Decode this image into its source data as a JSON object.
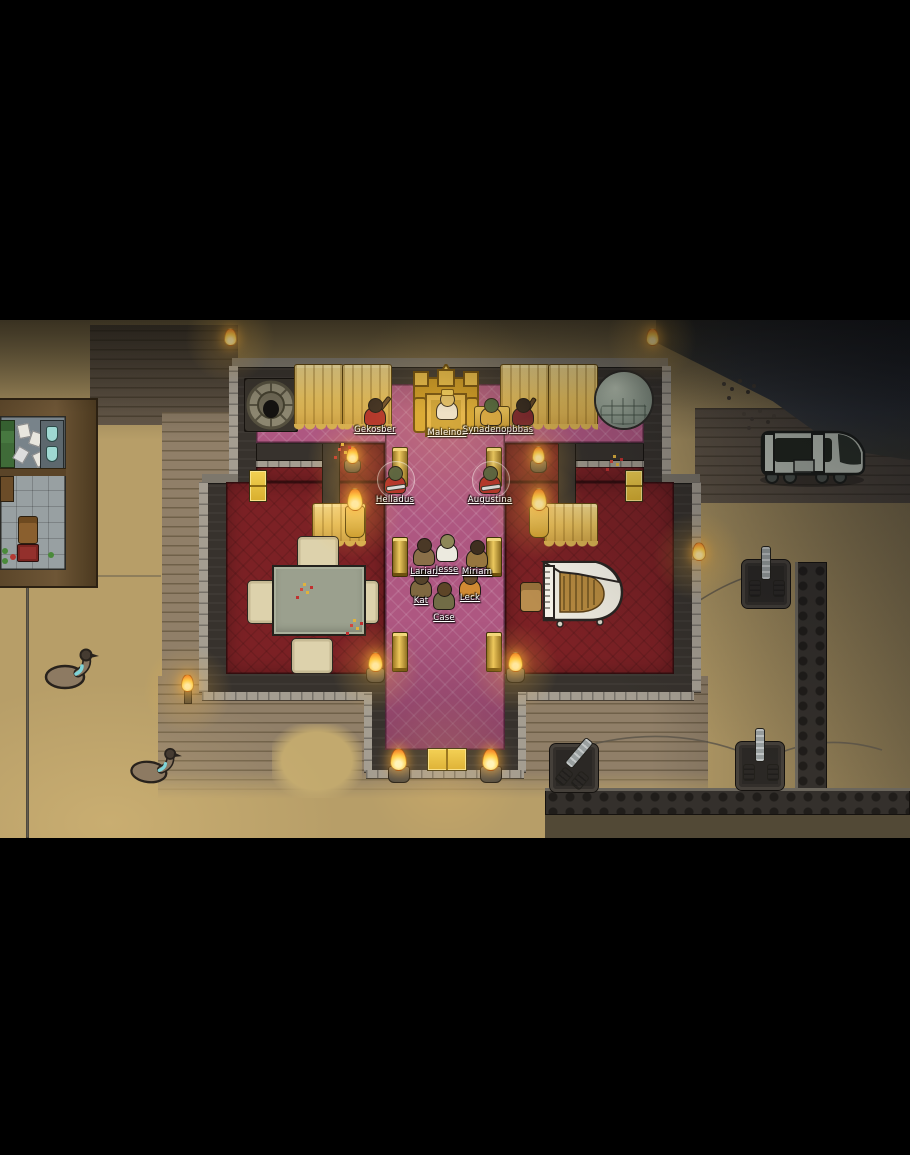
{
  "pawns": [
    {
      "name": "Gekosber",
      "outfit_color": "#b03028"
    },
    {
      "name": "Maleinos",
      "outfit_color": "#ece7db"
    },
    {
      "name": "Synadenopbbas",
      "outfit_color": "#d9a93f"
    },
    {
      "name": "Helladus",
      "outfit_color": "#b23028"
    },
    {
      "name": "Augustina",
      "outfit_color": "#b23028"
    },
    {
      "name": "Larian",
      "outfit_color": "#8a6f48"
    },
    {
      "name": "Jesse",
      "outfit_color": "#eceadf"
    },
    {
      "name": "Miriam",
      "outfit_color": "#97763f"
    },
    {
      "name": "Kat",
      "outfit_color": "#7f6840"
    },
    {
      "name": "Leck",
      "outfit_color": "#d18a33"
    },
    {
      "name": "Case",
      "outfit_color": "#716c46"
    }
  ],
  "entities": [
    "drum",
    "royal-drape",
    "golden-throne",
    "sphere-sculpture",
    "gold-column",
    "dining-table",
    "armchair",
    "grand-piano",
    "piano-stool",
    "brazier",
    "standing-torch",
    "gold-door",
    "mortar",
    "perimeter-wall",
    "power-conduit",
    "transport-vehicle",
    "emu",
    "research-room"
  ],
  "palette": {
    "letterbox": "#000000",
    "sand": "#b79e68",
    "brick": "#8a7963",
    "rock": "#41464c",
    "wall": "#37322d",
    "wall_face": "#a49d91",
    "carpet_pink": "#ae5781",
    "carpet_red": "#7c2125",
    "gold": "#e2b944",
    "flame": "#ffc945",
    "piano": "#efece0",
    "label_text": "#ffffff"
  }
}
